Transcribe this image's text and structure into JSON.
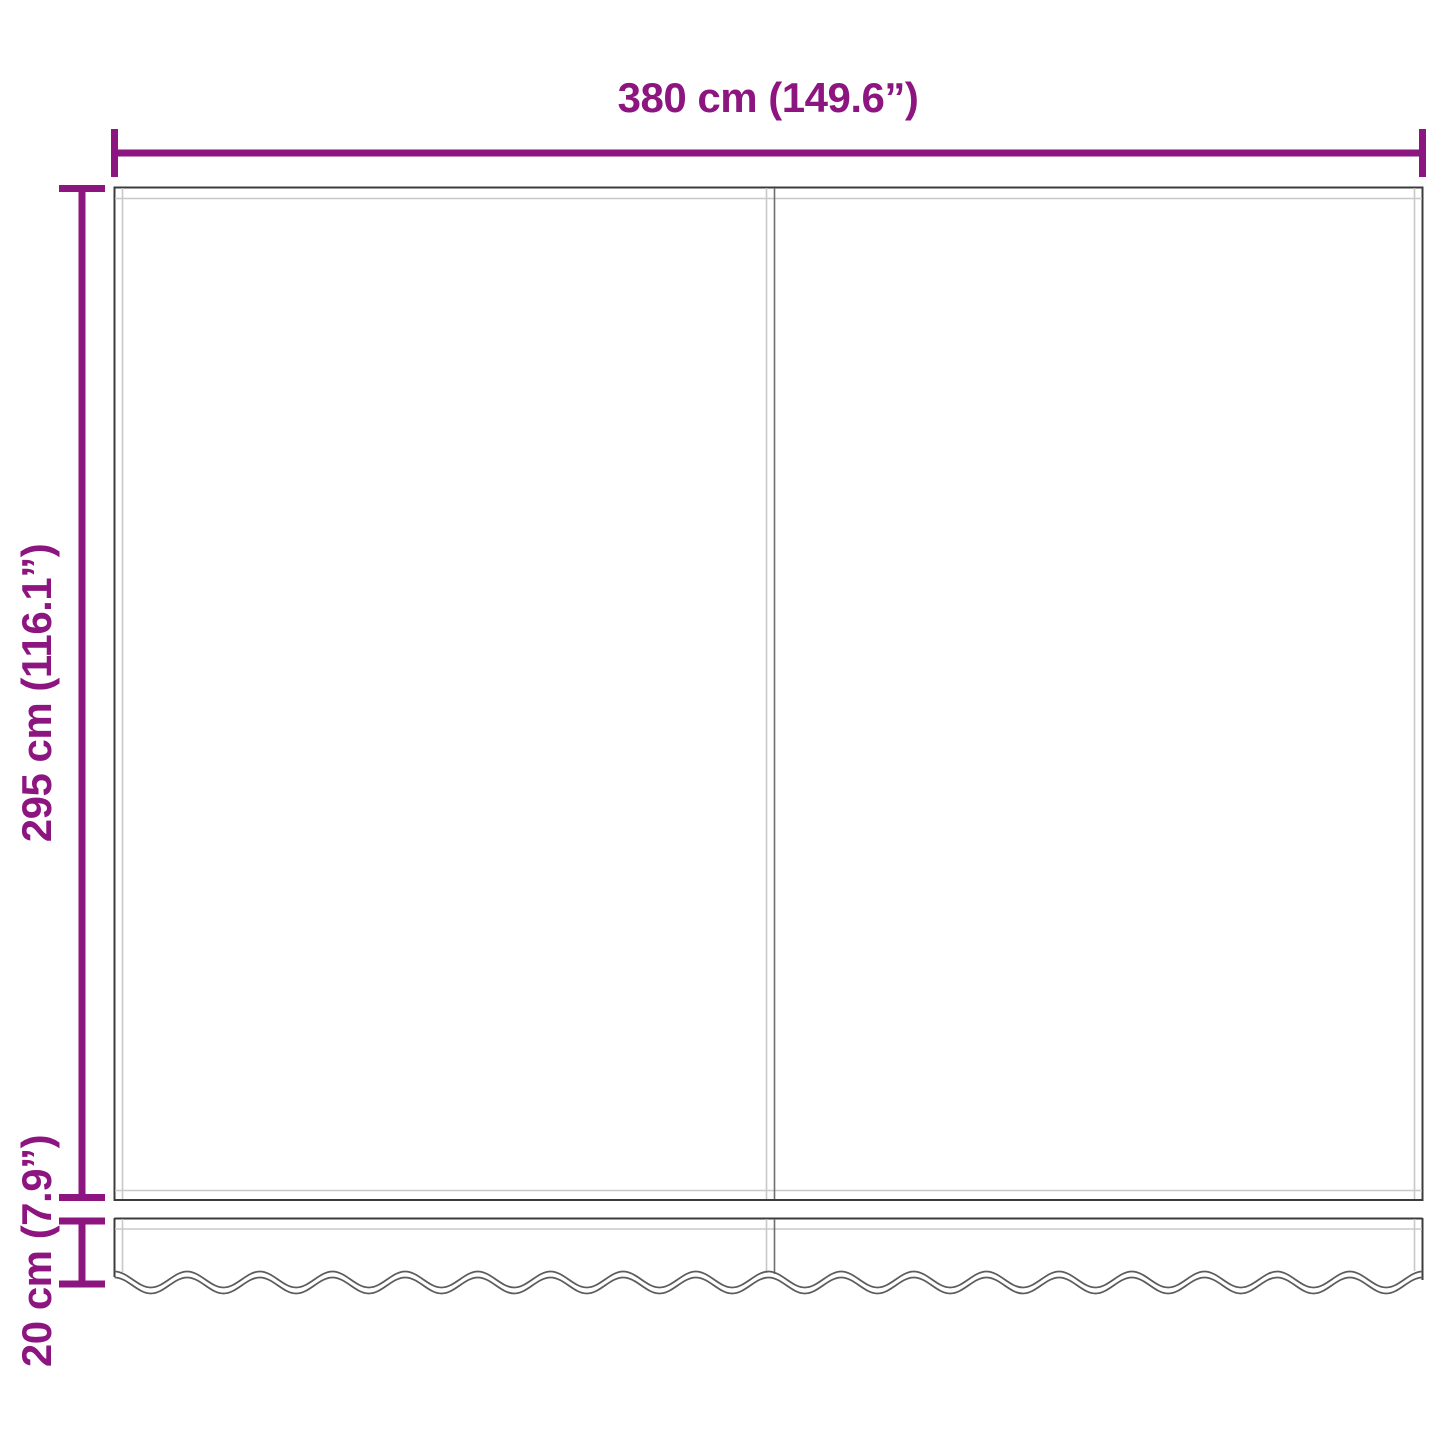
{
  "diagram": {
    "type": "product-dimension-diagram",
    "subject": "awning-replacement-fabric-with-valance",
    "dimensions": {
      "width": {
        "label": "380 cm (149.6”)",
        "cm": 380,
        "inches": 149.6
      },
      "height": {
        "label": "295 cm (116.1”)",
        "cm": 295,
        "inches": 116.1
      },
      "valance_height": {
        "label": "20 cm (7.9”)",
        "cm": 20,
        "inches": 7.9
      }
    }
  },
  "colors": {
    "dimension": "#8D1580",
    "outline": "#3C3C3C",
    "seam": "#C8C8C8",
    "divider": "#6E6E6E",
    "wave": "#5C5C5C",
    "bg": "#FFFFFF"
  }
}
